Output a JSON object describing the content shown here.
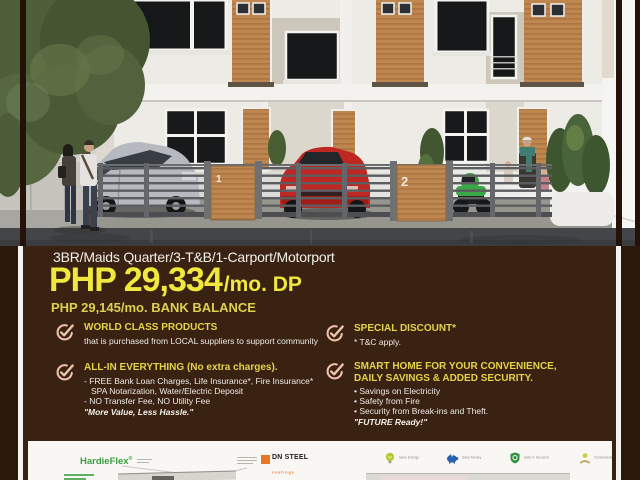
{
  "colors": {
    "outer_bg": "#2b190b",
    "content_bg": "#3a2213",
    "accent_yellow": "#f1e83d",
    "gold": "#e5d24b",
    "check_pink": "#eec3ac",
    "footer_bg": "#f8f7f4",
    "hardie_green": "#3a9e3d",
    "dn_orange": "#e87722"
  },
  "photo": {
    "unit_labels": [
      "1",
      "2"
    ]
  },
  "specs_line": "3BR/Maids Quarter/3-T&B/1-Carport/Motorport",
  "pricing": {
    "dp_main": "PHP 29,334",
    "dp_suffix": "/mo. DP",
    "balance": "PHP 29,145/mo. BANK BALANCE"
  },
  "features": {
    "left": [
      {
        "title": "WORLD CLASS PRODUCTS",
        "body_lines": [
          "that is purchased from LOCAL suppliers to support community"
        ]
      },
      {
        "title": "ALL-IN EVERYTHING (No extra charges).",
        "body_lines": [
          "- FREE Bank Loan Charges, Life Insurance*, Fire Insurance*",
          "SPA Notarization, Water/Electric Deposit",
          "- NO Transfer Fee, NO Utility Fee"
        ],
        "footnote": "\"More Value, Less Hassle.\""
      }
    ],
    "right": [
      {
        "title": "SPECIAL DISCOUNT*",
        "body_lines": [
          "* T&C apply."
        ]
      },
      {
        "title": "SMART HOME FOR YOUR CONVENIENCE, DAILY SAVINGS & ADDED SECURITY.",
        "body_lines": [
          "• Savings on Electricity",
          "• Safety from Fire",
          "• Security from Break-ins and Theft."
        ],
        "footnote": "\"FUTURE Ready!\""
      }
    ]
  },
  "footer": {
    "hardieflex_label": "HardieFlex",
    "dn_steel_label": "DN STEEL",
    "dn_steel_sub": "roofings",
    "eco_items": [
      {
        "icon": "bulb-icon",
        "label": "Save Energy"
      },
      {
        "icon": "piggy-bank-icon",
        "label": "Save Money"
      },
      {
        "icon": "shield-icon",
        "label": "Safe n' Secured"
      },
      {
        "icon": "hand-coin-icon",
        "label": "Convenience"
      }
    ]
  }
}
